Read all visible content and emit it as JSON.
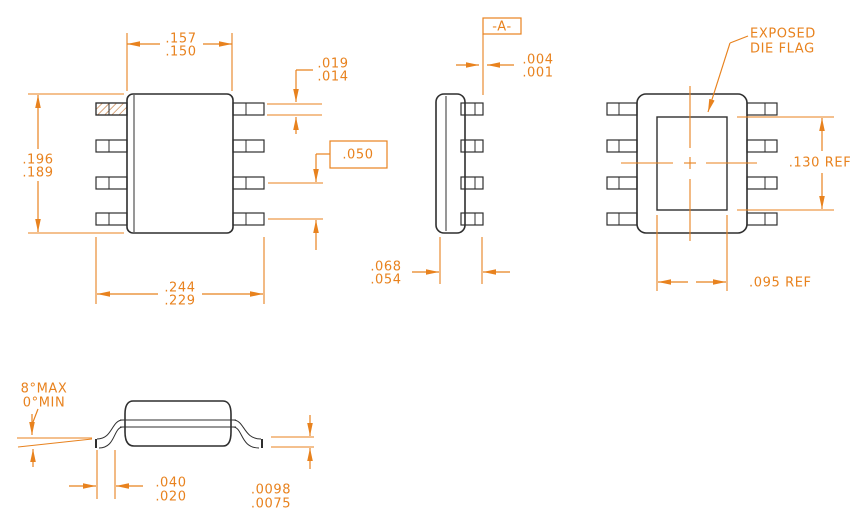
{
  "drawing": {
    "type": "mechanical-package-outline",
    "package_style": "8-lead small outline (SOIC) with exposed die flag",
    "colors": {
      "background": "#FFFFFF",
      "dimension": "#E8821E",
      "outline": "#2F2F2F",
      "pin1_hatch_fill": "#F6D7B5",
      "pin1_hatch_stroke": "#C0702E"
    },
    "views": {
      "top": {
        "dim_body_width_max": ".157",
        "dim_body_width_min": ".150",
        "dim_lead_width_max": ".019",
        "dim_lead_width_min": ".014",
        "dim_lead_pitch": ".050",
        "dim_body_length_max": ".196",
        "dim_body_length_min": ".189",
        "dim_span_max": ".244",
        "dim_span_min": ".229"
      },
      "end": {
        "datum": "-A-",
        "dim_tip_offset_max": ".004",
        "dim_tip_offset_min": ".001",
        "dim_thickness_max": ".068",
        "dim_thickness_min": ".054"
      },
      "bottom": {
        "callout_line1": "EXPOSED",
        "callout_line2": "DIE FLAG",
        "dim_pad_length": ".130 REF",
        "dim_pad_width": ".095 REF"
      },
      "side": {
        "lead_angle_max": "8°MAX",
        "lead_angle_min": "0°MIN",
        "dim_foot_max": ".040",
        "dim_foot_min": ".020",
        "dim_lead_thickness_max": ".0098",
        "dim_lead_thickness_min": ".0075"
      }
    }
  }
}
